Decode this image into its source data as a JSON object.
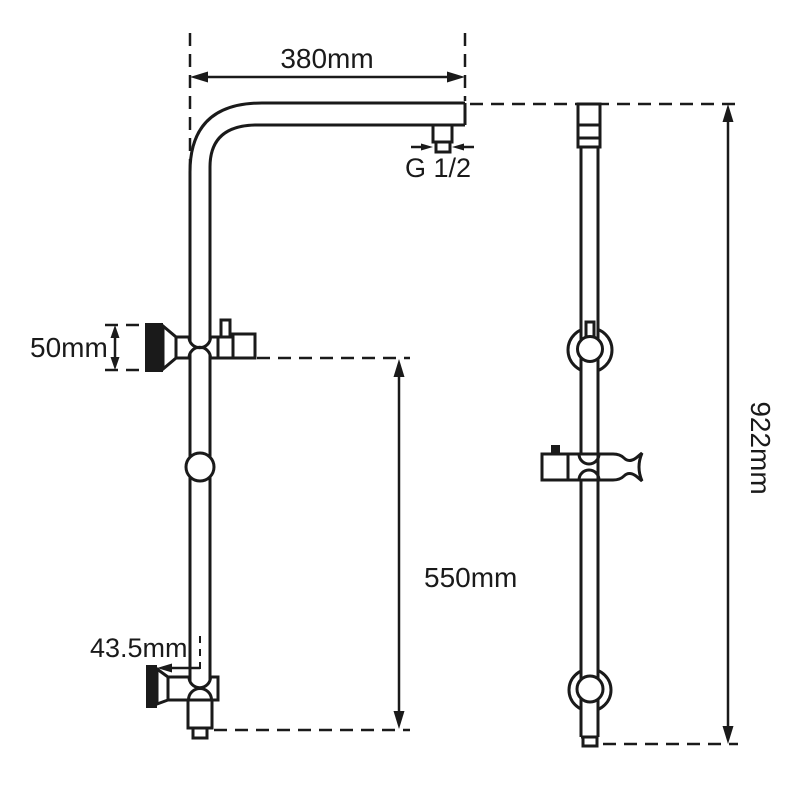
{
  "drawing": {
    "type": "shower-rail-dimension-diagram",
    "views": [
      "front-view-with-shower-arm",
      "side-profile-view"
    ],
    "labels": {
      "arm_width": "380mm",
      "inlet_thread": "G 1/2",
      "top_bracket_height": "50mm",
      "slide_length": "550mm",
      "bottom_offset": "43.5mm",
      "overall_height": "922mm"
    },
    "colors": {
      "line": "#1a1a1a",
      "background": "#ffffff"
    }
  }
}
